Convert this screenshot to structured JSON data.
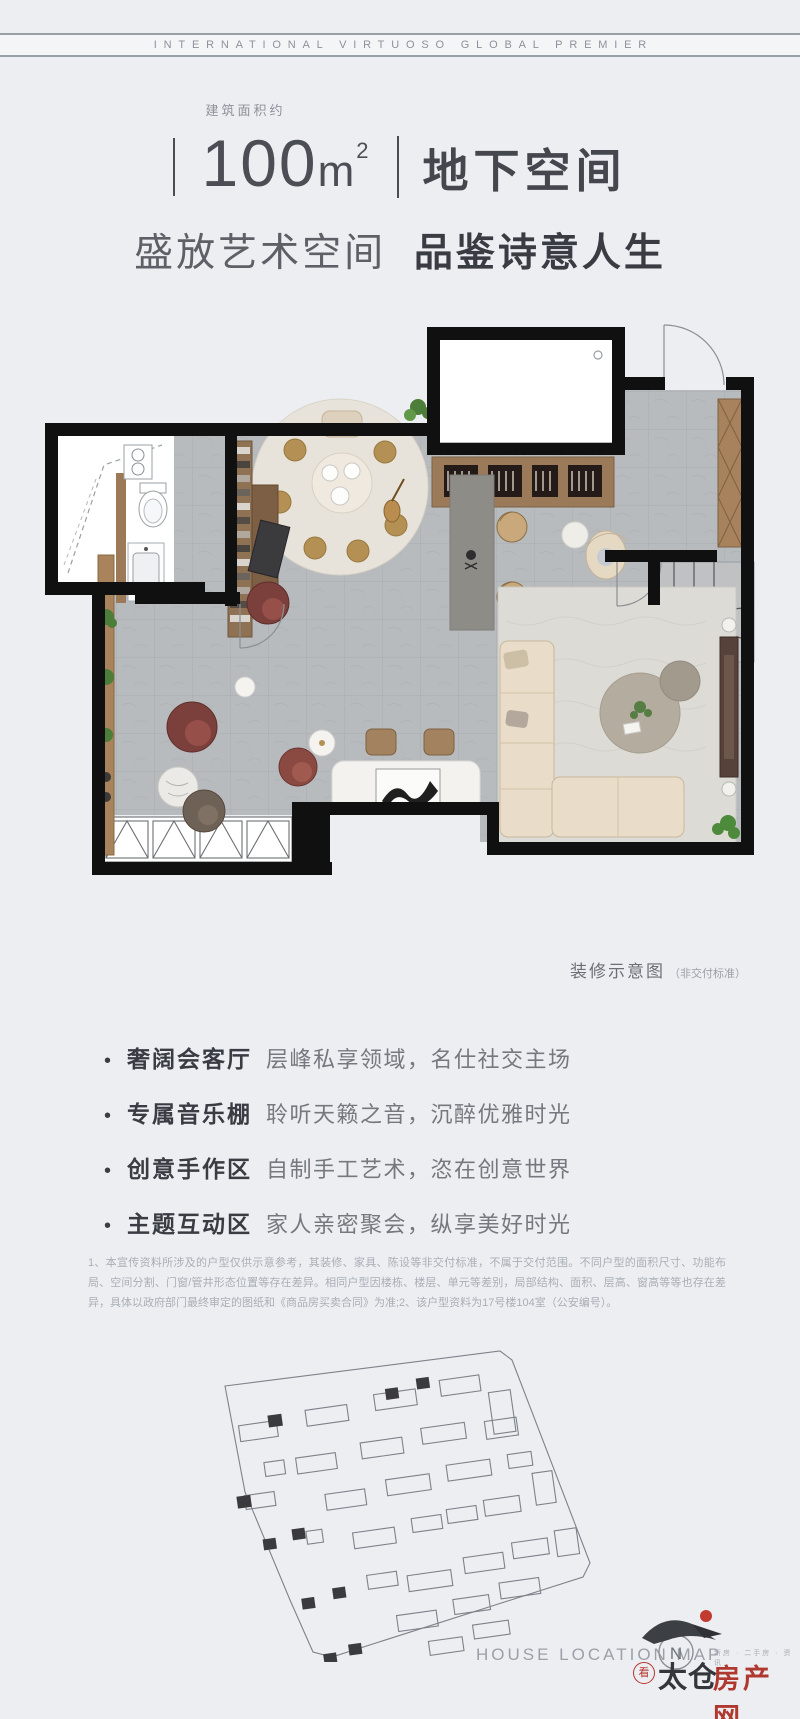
{
  "page": {
    "background": "#edeef2",
    "accent_red": "#b0392f",
    "wall_color": "#101010"
  },
  "top_banner": {
    "text": "INTERNATIONAL VIRTUOSO GLOBAL PREMIER"
  },
  "header": {
    "area_label": "建筑面积约",
    "area_value": "100",
    "area_unit": "m",
    "area_sup": "2",
    "space_name": "地下空间"
  },
  "subtitle": {
    "light": "盛放艺术空间",
    "bold": "品鉴诗意人生"
  },
  "floorplan": {
    "caption": "装修示意图",
    "caption_note": "（非交付标准）"
  },
  "features": [
    {
      "bullet": "•",
      "title": "奢阔会客厅",
      "desc": "层峰私享领域，名仕社交主场"
    },
    {
      "bullet": "•",
      "title": "专属音乐棚",
      "desc": "聆听天籁之音，沉醉优雅时光"
    },
    {
      "bullet": "•",
      "title": "创意手作区",
      "desc": "自制手工艺术，恣在创意世界"
    },
    {
      "bullet": "•",
      "title": "主题互动区",
      "desc": "家人亲密聚会，纵享美好时光"
    }
  ],
  "disclaimer": "1、本宣传资料所涉及的户型仅供示意参考，其装修、家具、陈设等非交付标准，不属于交付范围。不同户型的面积尺寸、功能布局、空间分割、门窗/管井形态位置等存在差异。相同户型因楼栋、楼层、单元等差别，局部结构、面积、层高、窗高等等也存在差异，具体以政府部门最终审定的图纸和《商品房买卖合同》为准;2、该户型资料为17号楼104室（公安编号）。",
  "footer": {
    "map_title": "HOUSE LOCATION MAP",
    "compass": "N",
    "logo_seal": "看",
    "logo_name": "太仓",
    "logo_tagline": "新房 · 二手房 · 资讯",
    "logo_suffix": "房产网"
  }
}
